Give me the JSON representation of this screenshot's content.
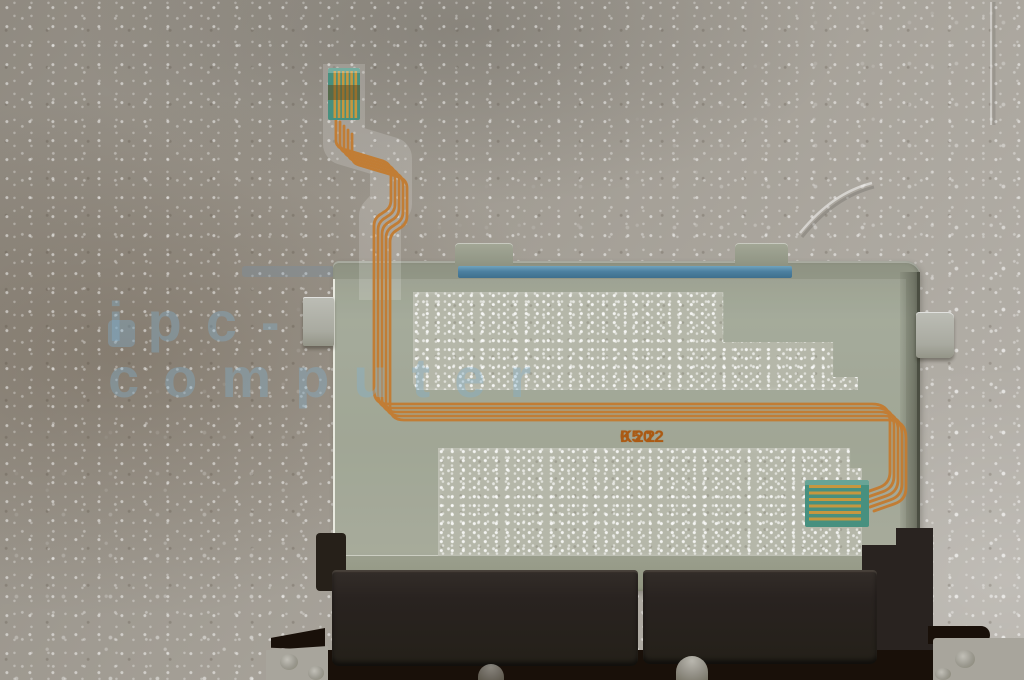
{
  "scene": {
    "description": "Photo of a laptop touchpad assembly (metal bracket, two black click buttons) with an orange flex ribbon cable, lying on white foam packaging"
  },
  "flex_label": {
    "model": "K22",
    "code": "0502"
  },
  "watermark": {
    "logo_icon": "watermark-logo-mark",
    "text": "ipc-computer"
  },
  "colors": {
    "foam_base": "#a39e95",
    "plate": "#949888",
    "plate_dark_edge": "#4b4e42",
    "film_highlight": "#e9eae0",
    "cable_film": "rgba(235,240,228,0.14)",
    "sparkle_base": "#b5b7a9",
    "blue_strip": "#4d80a0",
    "blue_strip_light": "#6fa3bf",
    "trace_orange": "#c17d35",
    "connector_teal": "#47907f",
    "connector_gold": "#c6973f",
    "label_orange": "#aa5a14",
    "button_black": "#292320",
    "band_black": "#191009",
    "notch_black": "#262019",
    "metal_grey": "#a8a59c",
    "screw_grey": "#97948b",
    "watermark_blue": "rgba(125,180,216,0.33)"
  }
}
